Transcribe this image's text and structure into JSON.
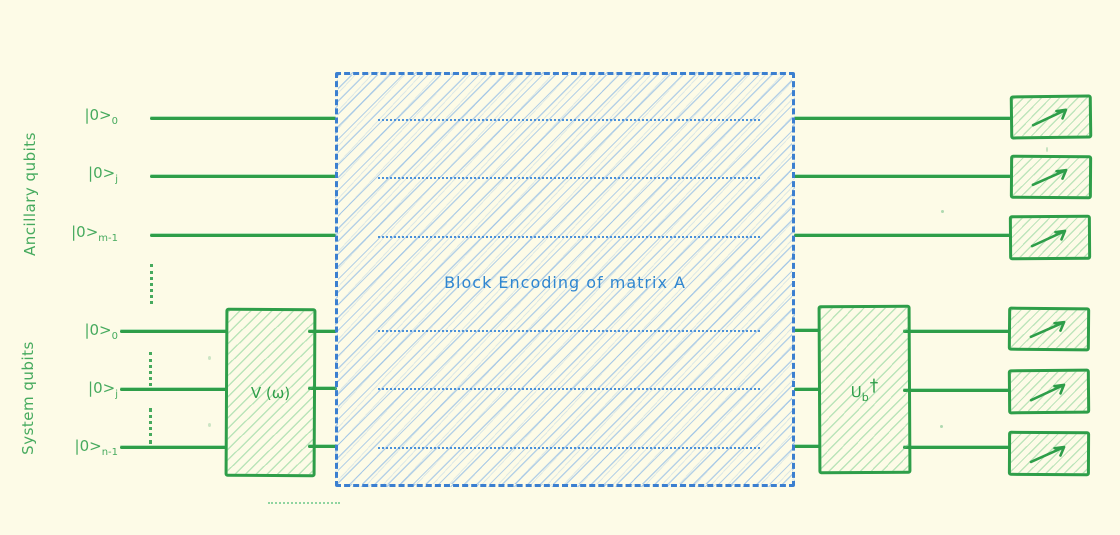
{
  "diagram": {
    "title_hidden": "",
    "type": "quantum-circuit-block-encoding"
  },
  "labels": {
    "ancillary_group": "Ancillary qubits",
    "system_group": "System qubits"
  },
  "qubits": {
    "ancillary": [
      {
        "base": "|0>",
        "sub": "0"
      },
      {
        "base": "|0>",
        "sub": "j"
      },
      {
        "base": "|0>",
        "sub": "m-1"
      }
    ],
    "system": [
      {
        "base": "|0>",
        "sub": "0"
      },
      {
        "base": "|0>",
        "sub": "j"
      },
      {
        "base": "|0>",
        "sub": "n-1"
      }
    ]
  },
  "gates": {
    "v": {
      "label": "V (ω)"
    },
    "block_encoding": {
      "label": "Block Encoding of matrix A"
    },
    "ub": {
      "base": "U",
      "sub": "b",
      "dagger": "†"
    }
  },
  "measurements": {
    "count": 6,
    "icon": "measure-arrow-icon"
  },
  "colors": {
    "background": "#fdfbe7",
    "green_stroke": "#2e9e49",
    "green_text": "#46aa5e",
    "green_hatch": "rgba(86,193,116,0.4)",
    "blue_stroke": "#3b7fd0",
    "blue_text": "#2f86d0",
    "blue_hatch": "rgba(111,168,230,0.5)"
  }
}
